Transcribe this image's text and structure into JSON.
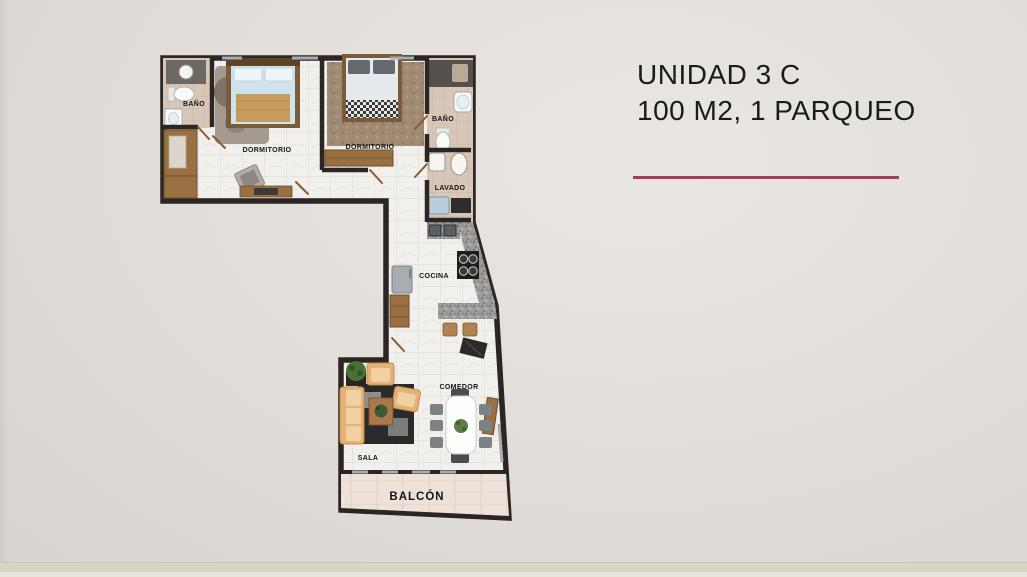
{
  "slide": {
    "background_color": "#e2deda",
    "footer_strip_color": "#d7d5c6"
  },
  "header": {
    "title": "UNIDAD 3 C",
    "subtitle": "100 M2, 1 PARQUEO",
    "accent_color": "#a83d56",
    "text_color": "#1b1b1b"
  },
  "floorplan": {
    "wall_color": "#2b2623",
    "floor_color": "#f2f0ec",
    "bath_floor_color": "#d8c7b8",
    "wood_color": "#9a6f42",
    "granite_color": "#9b9b9b",
    "balcony_floor_color": "#ede2d8",
    "sofa_color": "#e5b176",
    "rooms": [
      {
        "id": "bano-izquierdo",
        "label": "BAÑO"
      },
      {
        "id": "dormitorio-izquierdo",
        "label": "DORMITORIO"
      },
      {
        "id": "dormitorio-derecho",
        "label": "DORMITORIO"
      },
      {
        "id": "bano-derecho",
        "label": "BAÑO"
      },
      {
        "id": "lavado",
        "label": "LAVADO"
      },
      {
        "id": "cocina",
        "label": "COCINA"
      },
      {
        "id": "comedor",
        "label": "COMEDOR"
      },
      {
        "id": "sala",
        "label": "SALA"
      },
      {
        "id": "balcon",
        "label": "BALCÓN"
      }
    ]
  }
}
